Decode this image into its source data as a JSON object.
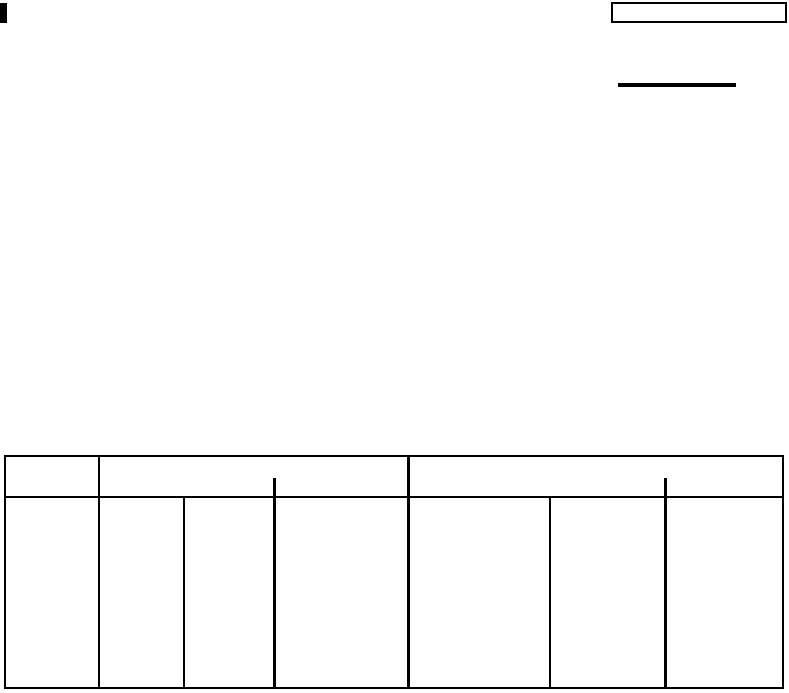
{
  "page": {
    "background_color": "#ffffff",
    "ink_color": "#000000"
  },
  "top_right_box": {
    "value": ""
  },
  "rule_line": {
    "value": ""
  },
  "table": {
    "header": {
      "first_column_label": "",
      "left_group_label": "",
      "right_group_label": ""
    },
    "body_cells": [
      "",
      "",
      "",
      "",
      "",
      "",
      ""
    ]
  }
}
